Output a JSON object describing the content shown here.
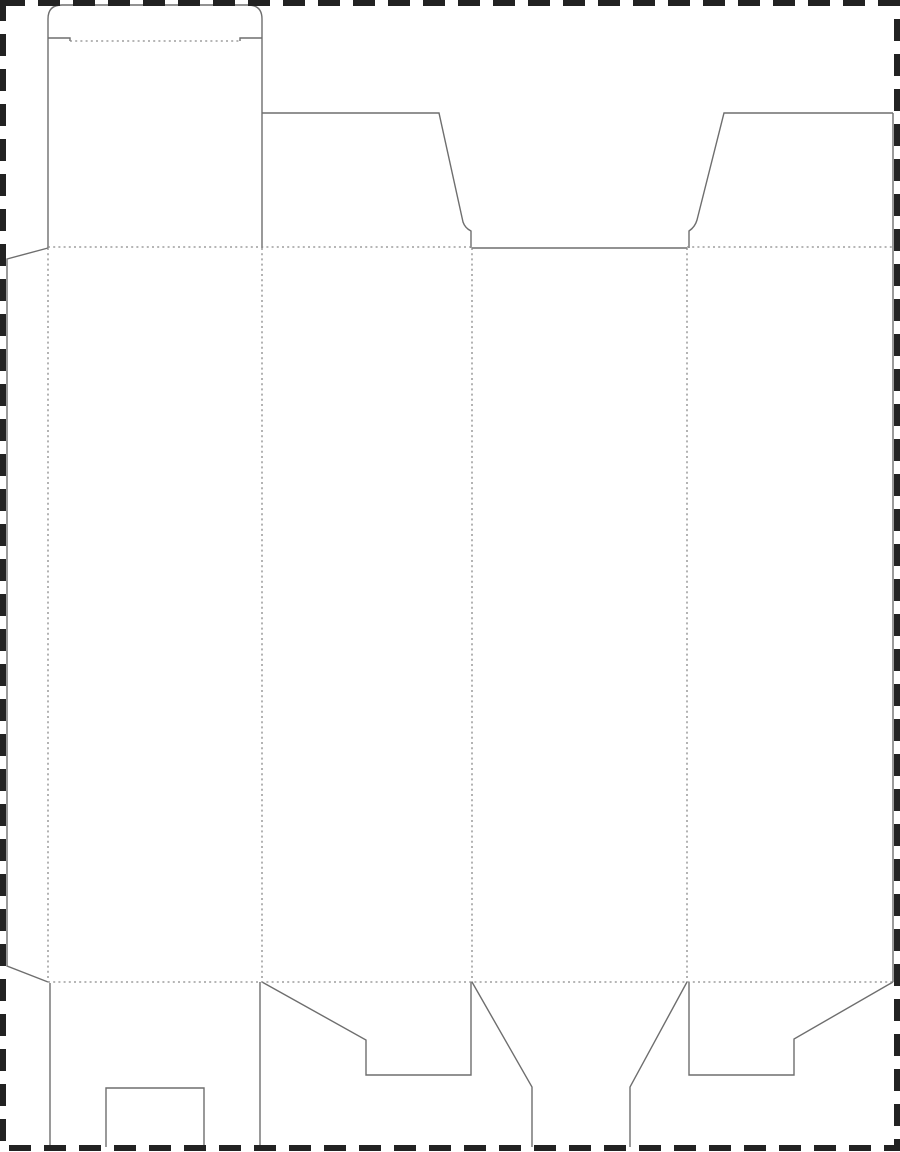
{
  "canvas": {
    "width": 900,
    "height": 1152,
    "background": "#ffffff"
  },
  "styles": {
    "cut_color": "#6e6e6e",
    "cut_width": 1.4,
    "fold_color": "#8a8a8a",
    "fold_width": 1.3,
    "fold_dash": "2 3.2",
    "border_color": "#222222",
    "border_width": 6,
    "border_dash": "22 13"
  },
  "border": {
    "x": 3,
    "y": 3,
    "width": 894,
    "height": 1145
  },
  "cut_lines": [
    {
      "name": "tuck-flap-outline",
      "d": "M 48 38 L 48 19 Q 48 5 62 5 L 248 5 Q 262 5 262 19 L 262 38"
    },
    {
      "name": "tuck-shoulder-left",
      "d": "M 48 38 L 70 38 L 70 41"
    },
    {
      "name": "tuck-shoulder-right",
      "d": "M 262 38 L 240 38 L 240 41"
    },
    {
      "name": "lid-column-left-edge",
      "d": "M 48 38 L 48 248"
    },
    {
      "name": "lid-column-right-edge",
      "d": "M 262 38 L 262 248"
    },
    {
      "name": "dust-flap-left",
      "d": "M 262 113 L 439 113 L 463 222 Q 465 228 471 231 L 471 248"
    },
    {
      "name": "front-panel-top-cut",
      "d": "M 472 248 L 687 248"
    },
    {
      "name": "dust-flap-right",
      "d": "M 893 113 L 724 113 L 697 220 Q 695 227 689 231 L 689 248"
    },
    {
      "name": "right-outer-edge",
      "d": "M 893 113 L 893 982"
    },
    {
      "name": "glue-flap-outline",
      "d": "M 48 248 L 7 259 L 7 966 L 48 982"
    },
    {
      "name": "back-bottom-flap-left-edge",
      "d": "M 50 983 L 50 1147"
    },
    {
      "name": "back-bottom-flap-right-edge",
      "d": "M 260 982 L 260 1147"
    },
    {
      "name": "back-bottom-flap-notch",
      "d": "M 106 1147 L 106 1088 L 204 1088 L 204 1147"
    },
    {
      "name": "side-bottom-flap-left",
      "d": "M 262 982 L 366 1040 L 366 1075 L 471 1075 L 471 982"
    },
    {
      "name": "front-bottom-tongue",
      "d": "M 472 982 L 532 1087 L 532 1147 M 630 1147 L 630 1087 L 687 982"
    },
    {
      "name": "side-bottom-flap-right",
      "d": "M 689 982 L 689 1075 L 794 1075 L 794 1039 L 893 982"
    }
  ],
  "fold_lines": [
    {
      "name": "tuck-flap-fold",
      "x1": 70,
      "y1": 41,
      "x2": 240,
      "y2": 41
    },
    {
      "name": "top-fold-left-section",
      "x1": 48,
      "y1": 247,
      "x2": 472,
      "y2": 247
    },
    {
      "name": "top-fold-right-section",
      "x1": 687,
      "y1": 247,
      "x2": 893,
      "y2": 247
    },
    {
      "name": "bottom-fold",
      "x1": 48,
      "y1": 982,
      "x2": 893,
      "y2": 982
    },
    {
      "name": "glue-flap-fold",
      "x1": 48,
      "y1": 248,
      "x2": 48,
      "y2": 982
    },
    {
      "name": "panel-fold-back-side",
      "x1": 262,
      "y1": 248,
      "x2": 262,
      "y2": 982
    },
    {
      "name": "panel-fold-side-front",
      "x1": 472,
      "y1": 248,
      "x2": 472,
      "y2": 982
    },
    {
      "name": "panel-fold-front-side",
      "x1": 687,
      "y1": 248,
      "x2": 687,
      "y2": 982
    }
  ]
}
